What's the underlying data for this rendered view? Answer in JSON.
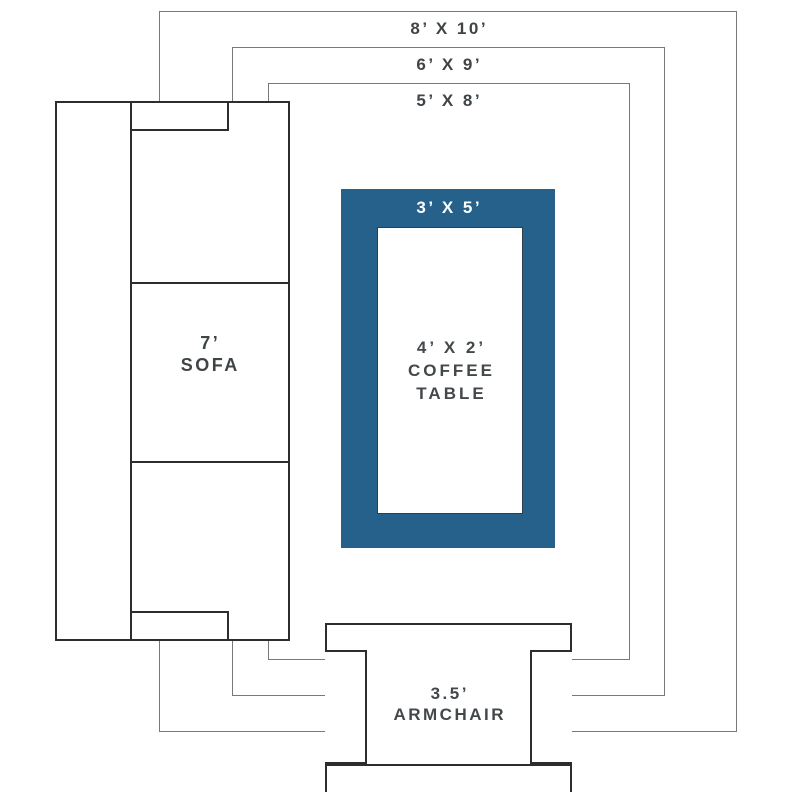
{
  "diagram": {
    "type": "rug-size-guide",
    "rugs": [
      {
        "id": "8x10",
        "label": "8’ X 10’"
      },
      {
        "id": "6x9",
        "label": "6’ X 9’"
      },
      {
        "id": "5x8",
        "label": "5’ X 8’"
      },
      {
        "id": "3x5",
        "label": "3’ X 5’",
        "fill": "#26618c"
      }
    ],
    "furniture": {
      "sofa": {
        "size": "7’",
        "name": "SOFA"
      },
      "coffee_table": {
        "size": "4’ X 2’",
        "name_line1": "COFFEE",
        "name_line2": "TABLE"
      },
      "armchair": {
        "size": "3.5’",
        "name": "ARMCHAIR"
      }
    },
    "colors": {
      "accent_rug_blue": "#26618c",
      "rug_outline_gray": "#75797c",
      "furniture_outline_dark": "#2b2d2f",
      "label_text": "#43484b",
      "rug_label_on_blue": "#ffffff",
      "background": "#ffffff"
    }
  }
}
